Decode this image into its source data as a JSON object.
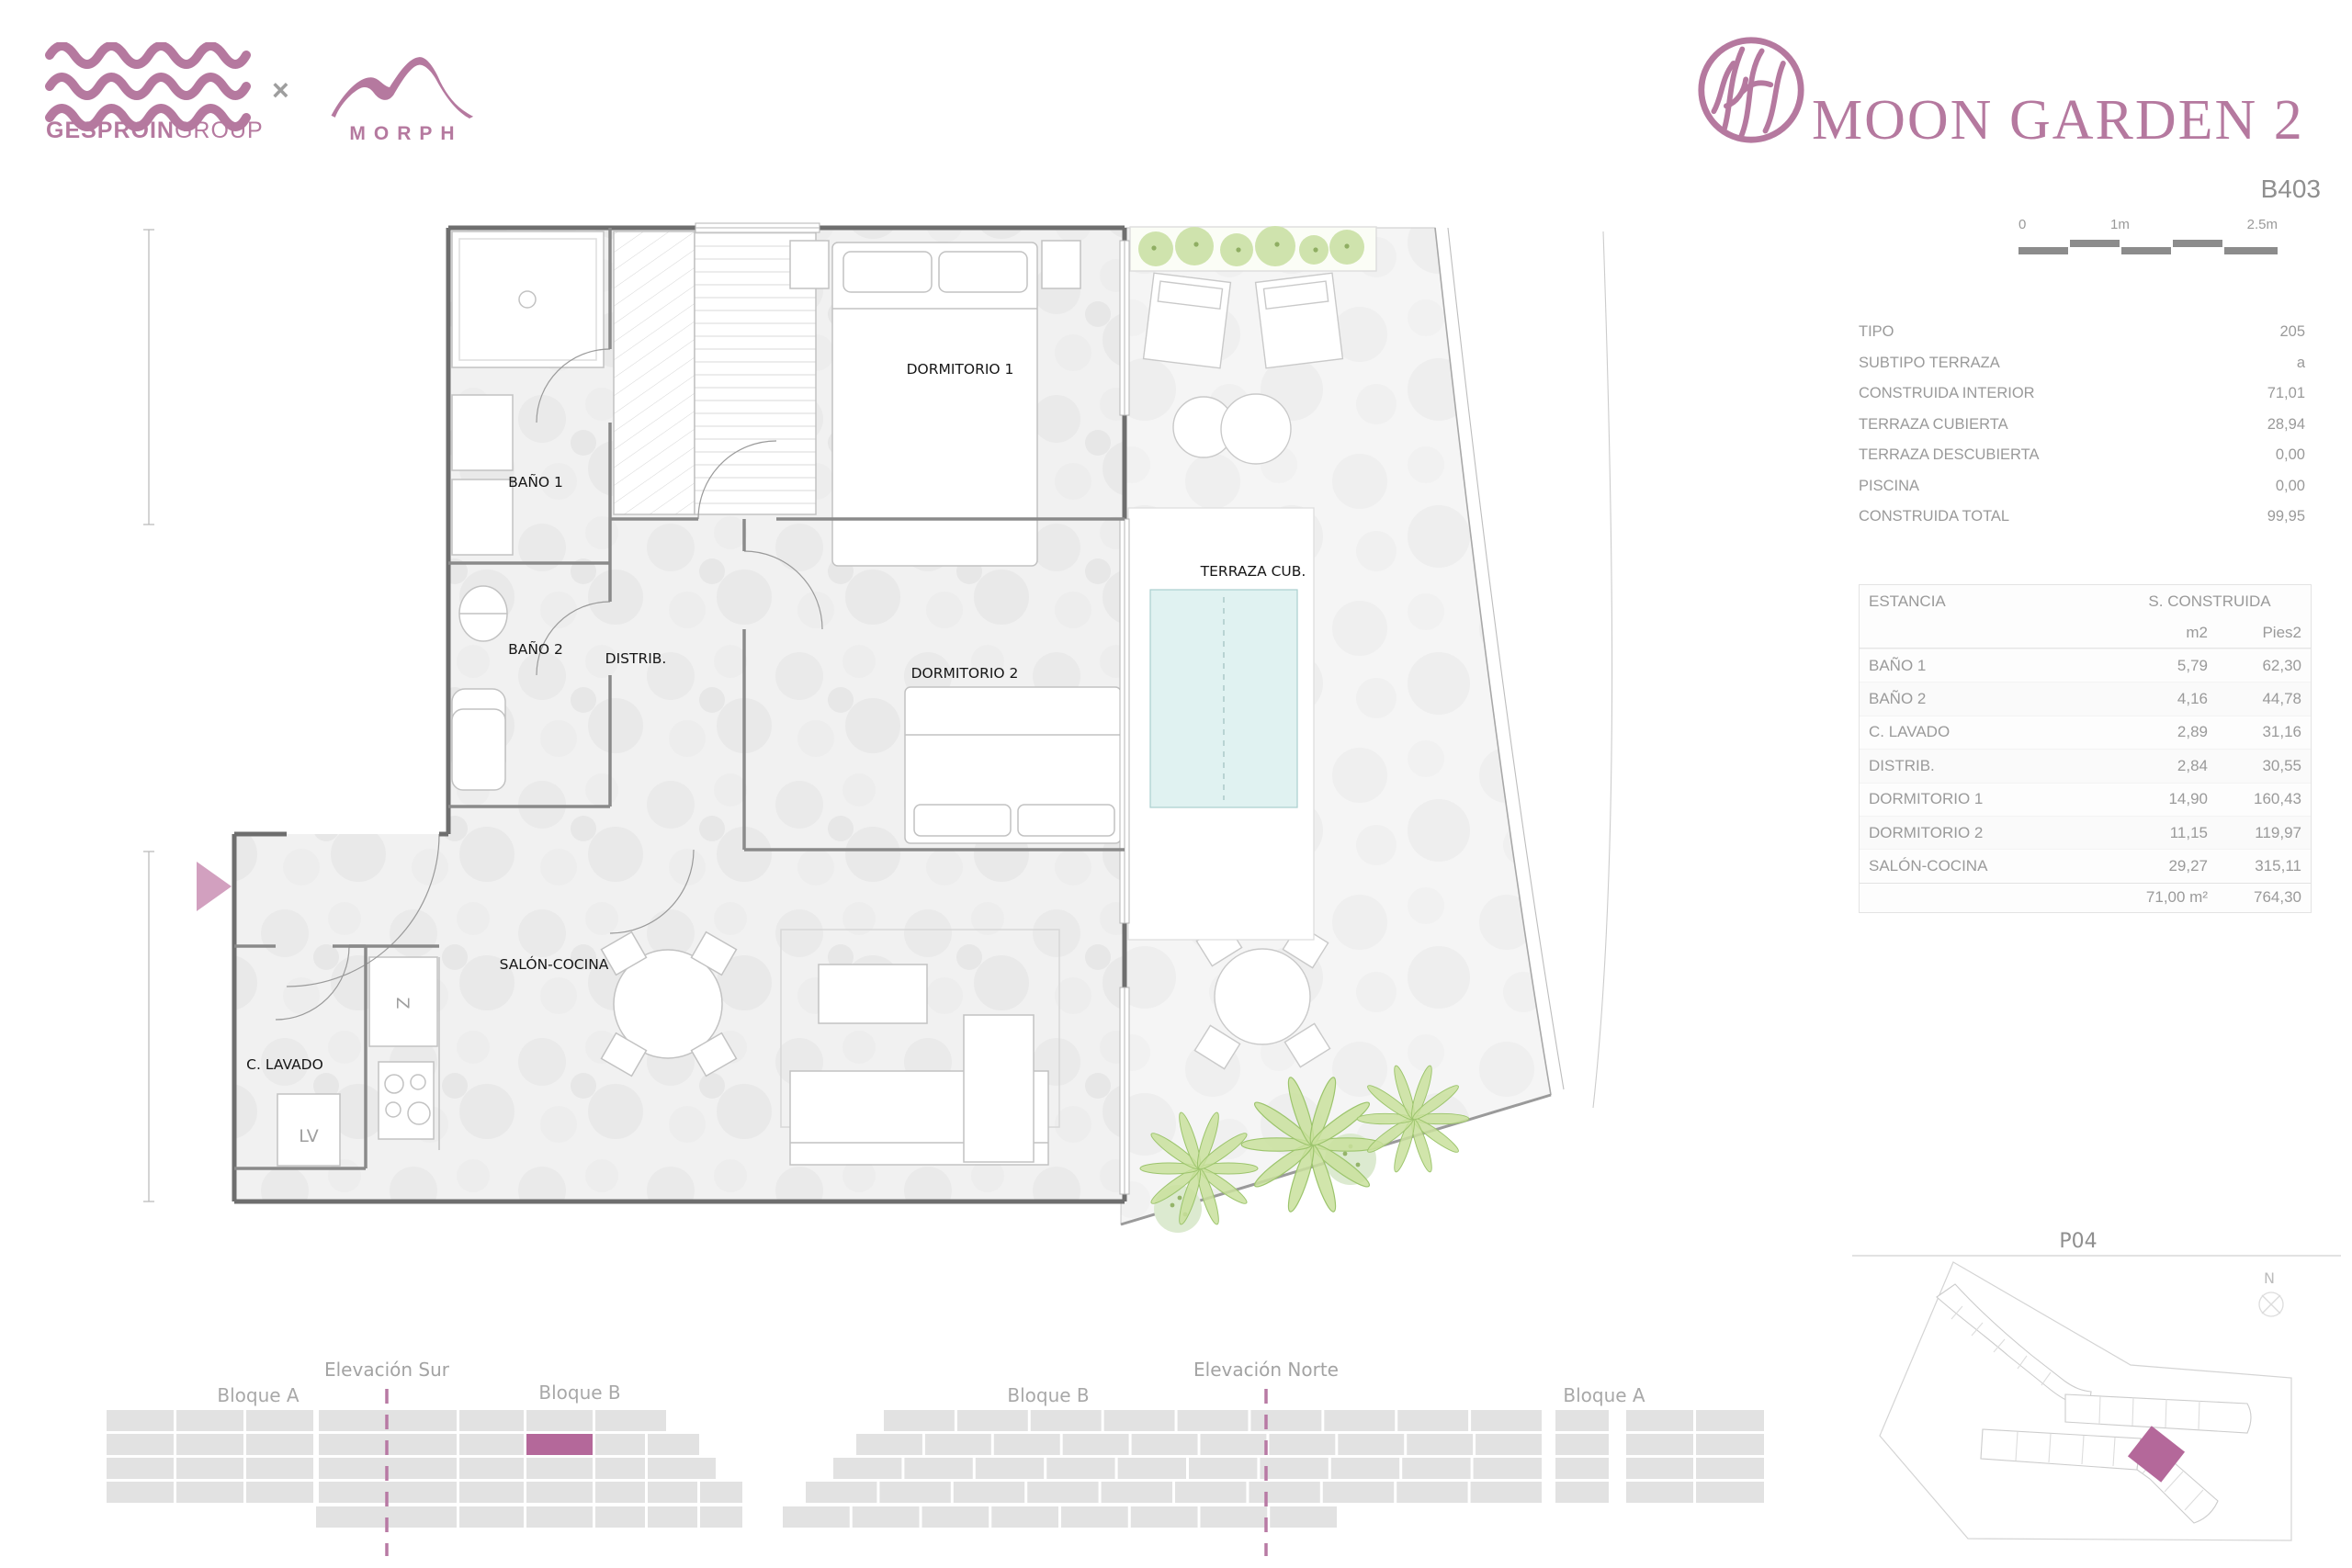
{
  "header": {
    "gesproin": {
      "bold": "GESPROIN",
      "light": "GROUP"
    },
    "collab_x": "×",
    "morph": "MORPH",
    "project": "MOON GARDEN 2",
    "unit": "B403"
  },
  "scalebar": {
    "zero": "0",
    "one": "1m",
    "two_half": "2.5m"
  },
  "summary": {
    "rows": [
      {
        "label": "TIPO",
        "value": "205"
      },
      {
        "label": "SUBTIPO TERRAZA",
        "value": "a"
      },
      {
        "label": "CONSTRUIDA INTERIOR",
        "value": "71,01"
      },
      {
        "label": "TERRAZA CUBIERTA",
        "value": "28,94"
      },
      {
        "label": "TERRAZA DESCUBIERTA",
        "value": "0,00"
      },
      {
        "label": "PISCINA",
        "value": "0,00"
      },
      {
        "label": "CONSTRUIDA TOTAL",
        "value": "99,95"
      }
    ]
  },
  "areas": {
    "col_room": "ESTANCIA",
    "col_built": "S. CONSTRUIDA",
    "col_m2": "m2",
    "col_pies2": "Pies2",
    "rows": [
      {
        "name": "BAÑO 1",
        "m2": "5,79",
        "pies2": "62,30"
      },
      {
        "name": "BAÑO 2",
        "m2": "4,16",
        "pies2": "44,78"
      },
      {
        "name": "C. LAVADO",
        "m2": "2,89",
        "pies2": "31,16"
      },
      {
        "name": "DISTRIB.",
        "m2": "2,84",
        "pies2": "30,55"
      },
      {
        "name": "DORMITORIO 1",
        "m2": "14,90",
        "pies2": "160,43"
      },
      {
        "name": "DORMITORIO 2",
        "m2": "11,15",
        "pies2": "119,97"
      },
      {
        "name": "SALÓN-COCINA",
        "m2": "29,27",
        "pies2": "315,11"
      }
    ],
    "total_m2": "71,00 m²",
    "total_pies2": "764,30"
  },
  "plan": {
    "rooms": [
      {
        "label": "DORMITORIO 1"
      },
      {
        "label": "BAÑO 1"
      },
      {
        "label": "BAÑO 2"
      },
      {
        "label": "DISTRIB."
      },
      {
        "label": "DORMITORIO 2"
      },
      {
        "label": "TERRAZA CUB."
      },
      {
        "label": "SALÓN-COCINA"
      },
      {
        "label": "C. LAVADO"
      }
    ],
    "lv": "LV",
    "fridge": "Z"
  },
  "elevations": {
    "sur": {
      "title": "Elevación Sur",
      "left": "Bloque A",
      "right": "Bloque B"
    },
    "norte": {
      "title": "Elevación Norte",
      "left": "Bloque B",
      "right": "Bloque A"
    }
  },
  "siteplan": {
    "title": "P04",
    "north": "N"
  },
  "colors": {
    "accent": "#b5799f",
    "highlight": "#b4689a",
    "cell": "#e2e2e2",
    "text_gray": "#9a9a9a"
  }
}
